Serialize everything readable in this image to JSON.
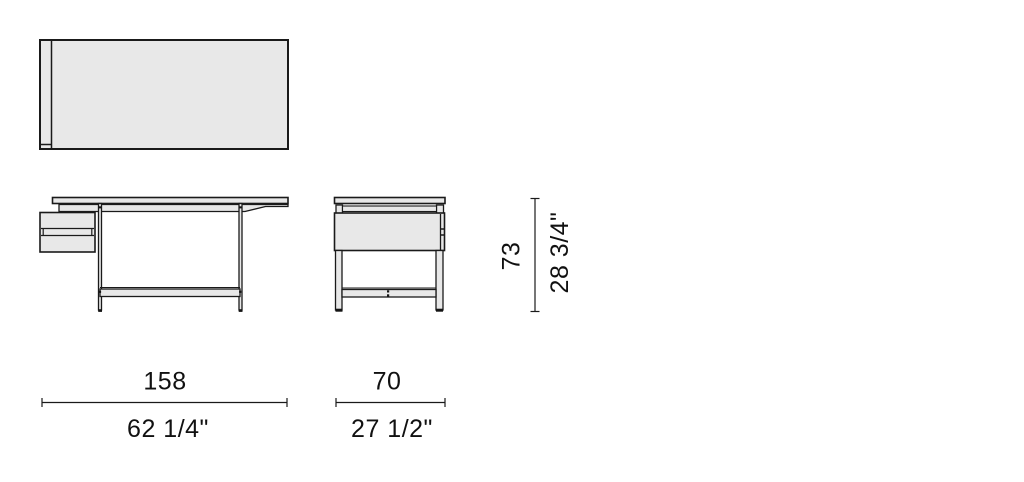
{
  "colors": {
    "background": "#ffffff",
    "line": "#1a1a1a",
    "panel_fill": "#e8e8e8",
    "text": "#111111"
  },
  "dimensions": {
    "width": {
      "metric": "158",
      "imperial": "62 1/4\""
    },
    "depth": {
      "metric": "70",
      "imperial": "27 1/2\""
    },
    "height": {
      "metric": "73",
      "imperial": "28 3/4\""
    }
  }
}
